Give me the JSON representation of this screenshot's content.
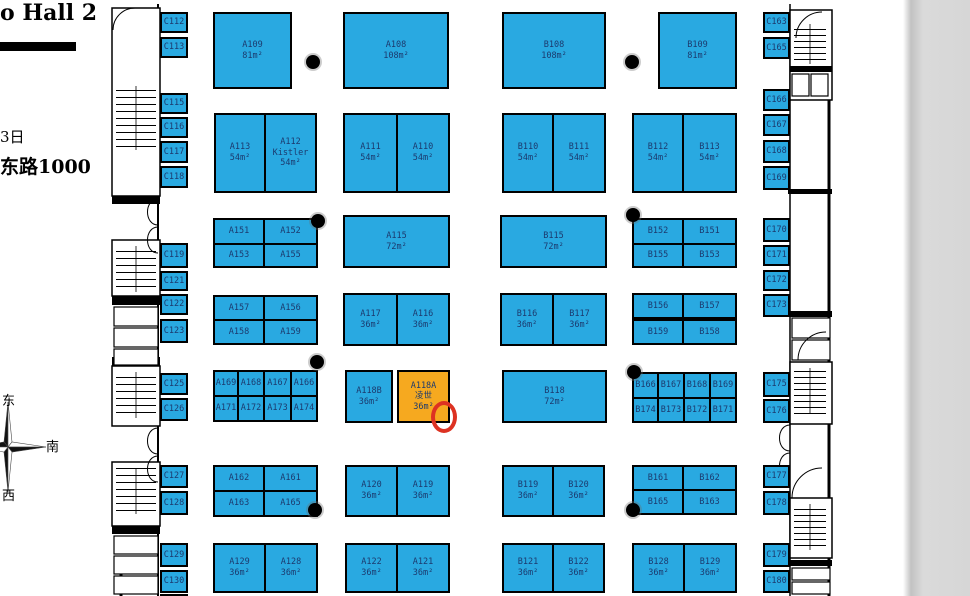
{
  "header": {
    "title": "o Hall 2",
    "date": "3日",
    "address": "东路1000"
  },
  "compass": {
    "top": "东",
    "right": "南",
    "bottom": "西"
  },
  "colors": {
    "booth_blue": "#29A9E1",
    "booth_highlight": "#F6A91F",
    "booth_text": "#1C3A6E",
    "annotation_red": "#DD3222"
  },
  "annotation": {
    "shape": "ellipse",
    "cx": 444,
    "cy": 417,
    "rx": 13,
    "ry": 16
  },
  "columns": [
    {
      "x": 313,
      "y": 62
    },
    {
      "x": 632,
      "y": 62
    },
    {
      "x": 318,
      "y": 221
    },
    {
      "x": 633,
      "y": 215
    },
    {
      "x": 317,
      "y": 362
    },
    {
      "x": 634,
      "y": 372
    },
    {
      "x": 315,
      "y": 510
    },
    {
      "x": 633,
      "y": 510
    }
  ],
  "booths": [
    {
      "id": "C112",
      "x": 160,
      "y": 12,
      "w": 28,
      "h": 21
    },
    {
      "id": "C113",
      "x": 160,
      "y": 37,
      "w": 28,
      "h": 21
    },
    {
      "id": "A109",
      "lines": [
        "A109",
        "81m²"
      ],
      "x": 213,
      "y": 12,
      "w": 79,
      "h": 77
    },
    {
      "id": "A108",
      "lines": [
        "A108",
        "108m²"
      ],
      "x": 343,
      "y": 12,
      "w": 106,
      "h": 77
    },
    {
      "id": "B108",
      "lines": [
        "B108",
        "108m²"
      ],
      "x": 502,
      "y": 12,
      "w": 104,
      "h": 77
    },
    {
      "id": "B109",
      "lines": [
        "B109",
        "81m²"
      ],
      "x": 658,
      "y": 12,
      "w": 79,
      "h": 77
    },
    {
      "id": "C163",
      "x": 763,
      "y": 12,
      "w": 27,
      "h": 21
    },
    {
      "id": "C165",
      "x": 763,
      "y": 37,
      "w": 27,
      "h": 22
    },
    {
      "id": "C115",
      "x": 160,
      "y": 93,
      "w": 28,
      "h": 21
    },
    {
      "id": "C116",
      "x": 160,
      "y": 117,
      "w": 28,
      "h": 21
    },
    {
      "id": "C117",
      "x": 160,
      "y": 141,
      "w": 28,
      "h": 22
    },
    {
      "id": "C118",
      "x": 160,
      "y": 166,
      "w": 28,
      "h": 22
    },
    {
      "id": "A113",
      "lines": [
        "A113",
        "54m²"
      ],
      "x": 214,
      "y": 113,
      "w": 52,
      "h": 80
    },
    {
      "id": "A112",
      "lines": [
        "A112",
        "Kistler",
        "54m²"
      ],
      "x": 264,
      "y": 113,
      "w": 53,
      "h": 80
    },
    {
      "id": "A111",
      "lines": [
        "A111",
        "54m²"
      ],
      "x": 343,
      "y": 113,
      "w": 55,
      "h": 80
    },
    {
      "id": "A110",
      "lines": [
        "A110",
        "54m²"
      ],
      "x": 396,
      "y": 113,
      "w": 54,
      "h": 80
    },
    {
      "id": "B110",
      "lines": [
        "B110",
        "54m²"
      ],
      "x": 502,
      "y": 113,
      "w": 52,
      "h": 80
    },
    {
      "id": "B111",
      "lines": [
        "B111",
        "54m²"
      ],
      "x": 552,
      "y": 113,
      "w": 54,
      "h": 80
    },
    {
      "id": "B112",
      "lines": [
        "B112",
        "54m²"
      ],
      "x": 632,
      "y": 113,
      "w": 52,
      "h": 80
    },
    {
      "id": "B113",
      "lines": [
        "B113",
        "54m²"
      ],
      "x": 682,
      "y": 113,
      "w": 55,
      "h": 80
    },
    {
      "id": "C166",
      "x": 763,
      "y": 89,
      "w": 27,
      "h": 22
    },
    {
      "id": "C167",
      "x": 763,
      "y": 114,
      "w": 27,
      "h": 22
    },
    {
      "id": "C168",
      "x": 763,
      "y": 140,
      "w": 27,
      "h": 23
    },
    {
      "id": "C169",
      "x": 763,
      "y": 166,
      "w": 27,
      "h": 24
    },
    {
      "id": "C119",
      "x": 160,
      "y": 243,
      "w": 28,
      "h": 25
    },
    {
      "id": "C121",
      "x": 160,
      "y": 271,
      "w": 28,
      "h": 20
    },
    {
      "id": "C122",
      "x": 160,
      "y": 294,
      "w": 28,
      "h": 21
    },
    {
      "id": "C123",
      "x": 160,
      "y": 319,
      "w": 28,
      "h": 24
    },
    {
      "id": "A151",
      "x": 213,
      "y": 218,
      "w": 52,
      "h": 27
    },
    {
      "id": "A152",
      "x": 263,
      "y": 218,
      "w": 55,
      "h": 27
    },
    {
      "id": "A153",
      "x": 213,
      "y": 243,
      "w": 52,
      "h": 25
    },
    {
      "id": "A155",
      "x": 263,
      "y": 243,
      "w": 55,
      "h": 25
    },
    {
      "id": "A115",
      "lines": [
        "A115",
        "72m²"
      ],
      "x": 343,
      "y": 215,
      "w": 107,
      "h": 53
    },
    {
      "id": "B115",
      "lines": [
        "B115",
        "72m²"
      ],
      "x": 500,
      "y": 215,
      "w": 107,
      "h": 53
    },
    {
      "id": "B152",
      "x": 632,
      "y": 218,
      "w": 52,
      "h": 27
    },
    {
      "id": "B151",
      "x": 682,
      "y": 218,
      "w": 55,
      "h": 27
    },
    {
      "id": "B155",
      "x": 632,
      "y": 243,
      "w": 52,
      "h": 25
    },
    {
      "id": "B153",
      "x": 682,
      "y": 243,
      "w": 55,
      "h": 25
    },
    {
      "id": "C170",
      "x": 763,
      "y": 218,
      "w": 27,
      "h": 24
    },
    {
      "id": "C171",
      "x": 763,
      "y": 245,
      "w": 27,
      "h": 21
    },
    {
      "id": "C172",
      "x": 763,
      "y": 270,
      "w": 27,
      "h": 21
    },
    {
      "id": "C173",
      "x": 763,
      "y": 294,
      "w": 27,
      "h": 23
    },
    {
      "id": "A157",
      "x": 213,
      "y": 295,
      "w": 52,
      "h": 26
    },
    {
      "id": "A156",
      "x": 263,
      "y": 295,
      "w": 55,
      "h": 26
    },
    {
      "id": "A158",
      "x": 213,
      "y": 319,
      "w": 52,
      "h": 26
    },
    {
      "id": "A159",
      "x": 263,
      "y": 319,
      "w": 55,
      "h": 26
    },
    {
      "id": "A117",
      "lines": [
        "A117",
        "36m²"
      ],
      "x": 343,
      "y": 293,
      "w": 55,
      "h": 53
    },
    {
      "id": "A116",
      "lines": [
        "A116",
        "36m²"
      ],
      "x": 396,
      "y": 293,
      "w": 54,
      "h": 53
    },
    {
      "id": "B116",
      "lines": [
        "B116",
        "36m²"
      ],
      "x": 500,
      "y": 293,
      "w": 54,
      "h": 53
    },
    {
      "id": "B117",
      "lines": [
        "B117",
        "36m²"
      ],
      "x": 552,
      "y": 293,
      "w": 55,
      "h": 53
    },
    {
      "id": "B156",
      "x": 632,
      "y": 293,
      "w": 52,
      "h": 26
    },
    {
      "id": "B157",
      "x": 682,
      "y": 293,
      "w": 55,
      "h": 26
    },
    {
      "id": "B159",
      "x": 632,
      "y": 319,
      "w": 52,
      "h": 26
    },
    {
      "id": "B158",
      "x": 682,
      "y": 319,
      "w": 55,
      "h": 26
    },
    {
      "id": "C125",
      "x": 160,
      "y": 373,
      "w": 28,
      "h": 22
    },
    {
      "id": "C126",
      "x": 160,
      "y": 398,
      "w": 28,
      "h": 23
    },
    {
      "id": "A169",
      "x": 213,
      "y": 370,
      "w": 26,
      "h": 27
    },
    {
      "id": "A168",
      "x": 237,
      "y": 370,
      "w": 28,
      "h": 27
    },
    {
      "id": "A167",
      "x": 263,
      "y": 370,
      "w": 29,
      "h": 27
    },
    {
      "id": "A166",
      "x": 290,
      "y": 370,
      "w": 28,
      "h": 27
    },
    {
      "id": "A171",
      "x": 213,
      "y": 395,
      "w": 26,
      "h": 27
    },
    {
      "id": "A172",
      "x": 237,
      "y": 395,
      "w": 28,
      "h": 27
    },
    {
      "id": "A173",
      "x": 263,
      "y": 395,
      "w": 29,
      "h": 27
    },
    {
      "id": "A174",
      "x": 290,
      "y": 395,
      "w": 28,
      "h": 27
    },
    {
      "id": "A118B",
      "lines": [
        "A118B",
        "36m²"
      ],
      "x": 345,
      "y": 370,
      "w": 48,
      "h": 53
    },
    {
      "id": "A118A",
      "lines": [
        "A118A",
        "凌世",
        "36m²"
      ],
      "x": 397,
      "y": 370,
      "w": 53,
      "h": 53,
      "highlight": true
    },
    {
      "id": "B118",
      "lines": [
        "B118",
        "72m²"
      ],
      "x": 502,
      "y": 370,
      "w": 105,
      "h": 53
    },
    {
      "id": "B166",
      "x": 632,
      "y": 372,
      "w": 27,
      "h": 27
    },
    {
      "id": "B167",
      "x": 657,
      "y": 372,
      "w": 28,
      "h": 27
    },
    {
      "id": "B168",
      "x": 683,
      "y": 372,
      "w": 28,
      "h": 27
    },
    {
      "id": "B169",
      "x": 709,
      "y": 372,
      "w": 28,
      "h": 27
    },
    {
      "id": "B174",
      "x": 632,
      "y": 397,
      "w": 27,
      "h": 26
    },
    {
      "id": "B173",
      "x": 657,
      "y": 397,
      "w": 28,
      "h": 26
    },
    {
      "id": "B172",
      "x": 683,
      "y": 397,
      "w": 28,
      "h": 26
    },
    {
      "id": "B171",
      "x": 709,
      "y": 397,
      "w": 28,
      "h": 26
    },
    {
      "id": "C175",
      "x": 763,
      "y": 372,
      "w": 27,
      "h": 25
    },
    {
      "id": "C176",
      "x": 763,
      "y": 399,
      "w": 27,
      "h": 24
    },
    {
      "id": "C127",
      "x": 160,
      "y": 465,
      "w": 28,
      "h": 23
    },
    {
      "id": "C128",
      "x": 160,
      "y": 491,
      "w": 28,
      "h": 24
    },
    {
      "id": "A162",
      "x": 213,
      "y": 465,
      "w": 52,
      "h": 27
    },
    {
      "id": "A161",
      "x": 263,
      "y": 465,
      "w": 55,
      "h": 27
    },
    {
      "id": "A163",
      "x": 213,
      "y": 490,
      "w": 52,
      "h": 27
    },
    {
      "id": "A165",
      "x": 263,
      "y": 490,
      "w": 55,
      "h": 27
    },
    {
      "id": "A120",
      "lines": [
        "A120",
        "36m²"
      ],
      "x": 345,
      "y": 465,
      "w": 53,
      "h": 52
    },
    {
      "id": "A119",
      "lines": [
        "A119",
        "36m²"
      ],
      "x": 396,
      "y": 465,
      "w": 54,
      "h": 52
    },
    {
      "id": "B119",
      "lines": [
        "B119",
        "36m²"
      ],
      "x": 502,
      "y": 465,
      "w": 52,
      "h": 52
    },
    {
      "id": "B120",
      "lines": [
        "B120",
        "36m²"
      ],
      "x": 552,
      "y": 465,
      "w": 53,
      "h": 52
    },
    {
      "id": "B161",
      "x": 632,
      "y": 465,
      "w": 52,
      "h": 26
    },
    {
      "id": "B162",
      "x": 682,
      "y": 465,
      "w": 55,
      "h": 26
    },
    {
      "id": "B165",
      "x": 632,
      "y": 489,
      "w": 52,
      "h": 26
    },
    {
      "id": "B163",
      "x": 682,
      "y": 489,
      "w": 55,
      "h": 26
    },
    {
      "id": "C177",
      "x": 763,
      "y": 465,
      "w": 27,
      "h": 23
    },
    {
      "id": "C178",
      "x": 763,
      "y": 491,
      "w": 27,
      "h": 24
    },
    {
      "id": "C129",
      "x": 160,
      "y": 543,
      "w": 28,
      "h": 24
    },
    {
      "id": "C130",
      "x": 160,
      "y": 570,
      "w": 28,
      "h": 23
    },
    {
      "id": "A129",
      "lines": [
        "A129",
        "36m²"
      ],
      "x": 213,
      "y": 543,
      "w": 53,
      "h": 50
    },
    {
      "id": "A128",
      "lines": [
        "A128",
        "36m²"
      ],
      "x": 264,
      "y": 543,
      "w": 54,
      "h": 50
    },
    {
      "id": "A122",
      "lines": [
        "A122",
        "36m²"
      ],
      "x": 345,
      "y": 543,
      "w": 53,
      "h": 50
    },
    {
      "id": "A121",
      "lines": [
        "A121",
        "36m²"
      ],
      "x": 396,
      "y": 543,
      "w": 54,
      "h": 50
    },
    {
      "id": "B121",
      "lines": [
        "B121",
        "36m²"
      ],
      "x": 502,
      "y": 543,
      "w": 52,
      "h": 50
    },
    {
      "id": "B122",
      "lines": [
        "B122",
        "36m²"
      ],
      "x": 552,
      "y": 543,
      "w": 53,
      "h": 50
    },
    {
      "id": "B128",
      "lines": [
        "B128",
        "36m²"
      ],
      "x": 632,
      "y": 543,
      "w": 53,
      "h": 50
    },
    {
      "id": "B129",
      "lines": [
        "B129",
        "36m²"
      ],
      "x": 683,
      "y": 543,
      "w": 54,
      "h": 50
    },
    {
      "id": "C179",
      "x": 763,
      "y": 543,
      "w": 27,
      "h": 24
    },
    {
      "id": "C180",
      "x": 763,
      "y": 570,
      "w": 27,
      "h": 23
    },
    {
      "id": "",
      "lines": [],
      "x": 160,
      "y": 594,
      "w": 28,
      "h": 2
    }
  ]
}
